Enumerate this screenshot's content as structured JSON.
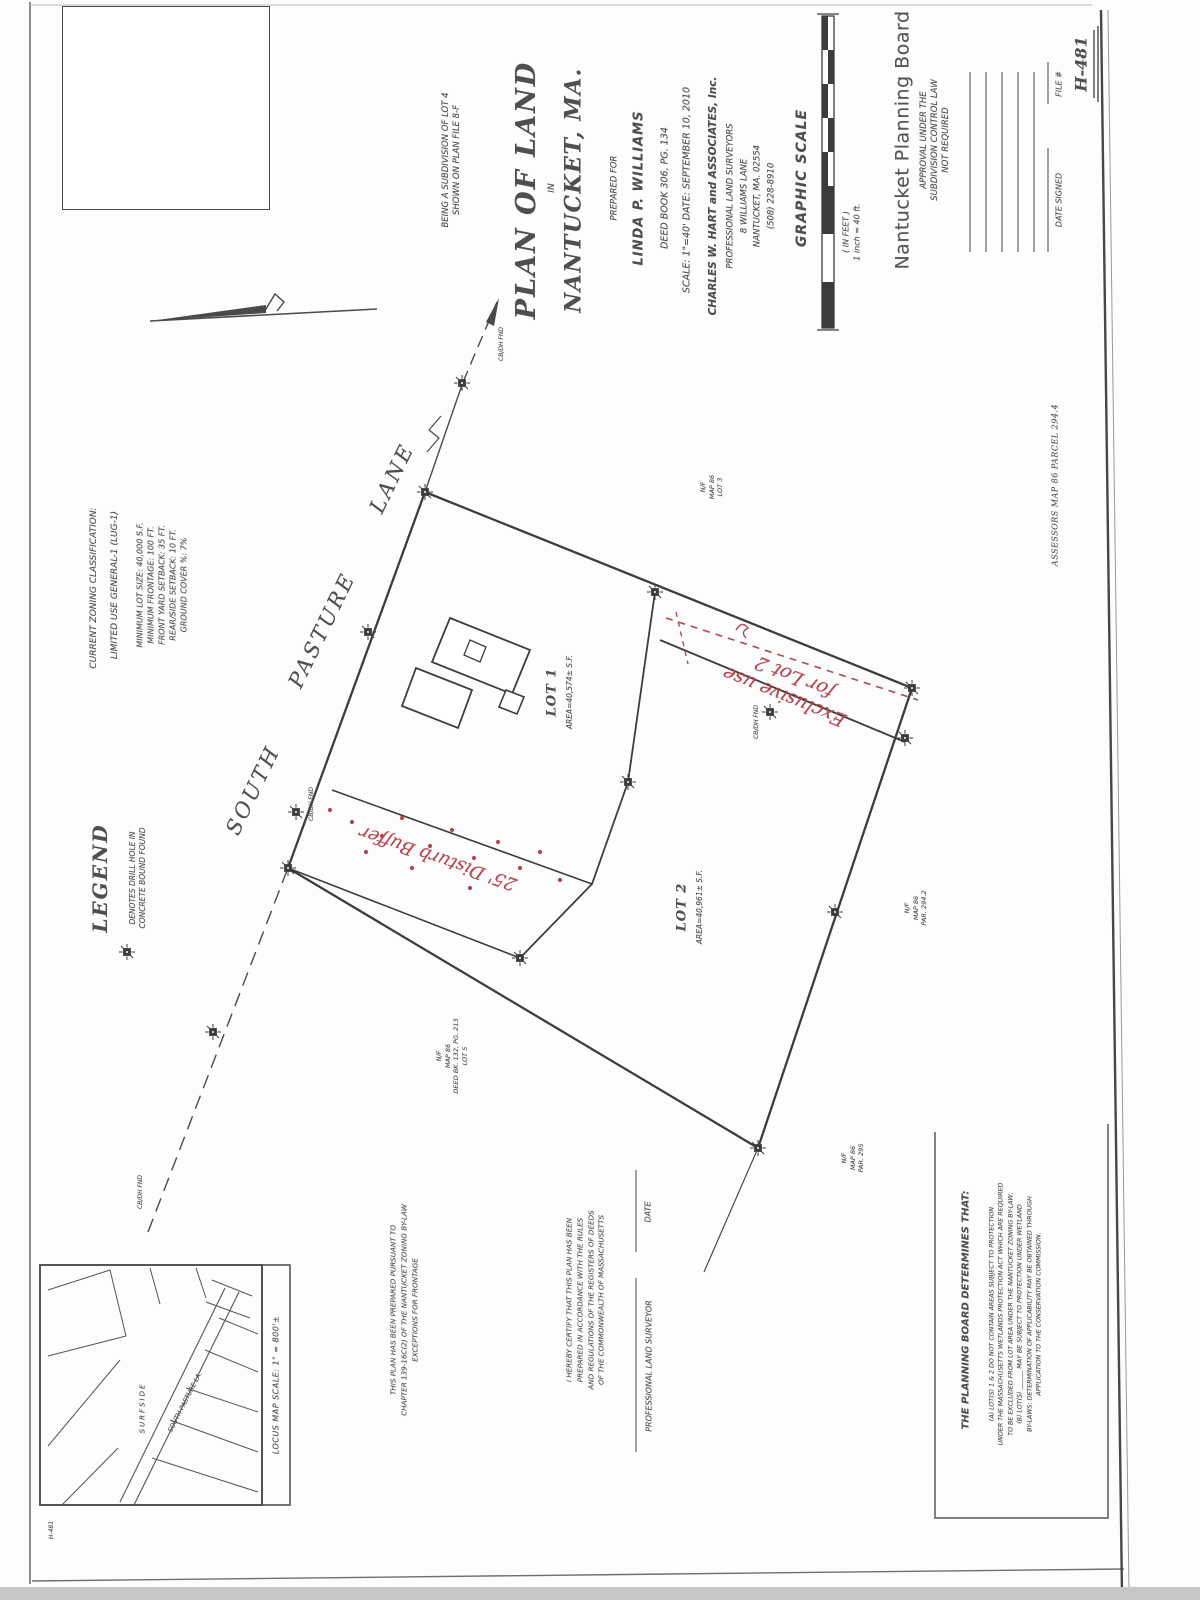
{
  "sheet": {
    "number": "H-481",
    "corner_note": "H-481",
    "assessors_note": "ASSESSORS MAP 86   PARCEL 294.4"
  },
  "title_block": {
    "subdivision_note_line1": "BEING A SUBDIVISION OF LOT 4",
    "subdivision_note_line2": "SHOWN ON PLAN FILE 8-F",
    "title_line1": "PLAN OF LAND",
    "title_in": "IN",
    "title_line2": "NANTUCKET, MA.",
    "prepared_for_label": "PREPARED FOR",
    "client": "LINDA P. WILLIAMS",
    "deed_ref": "DEED BOOK 306, PG. 134",
    "scale_date": "SCALE: 1\"=40'    DATE: SEPTEMBER 10, 2010",
    "firm": "CHARLES W. HART and ASSOCIATES, Inc.",
    "firm_line2": "PROFESSIONAL LAND SURVEYORS",
    "firm_addr1": "8 WILLIAMS LANE",
    "firm_addr2": "NANTUCKET, MA. 02554",
    "firm_phone": "(508) 228-8910"
  },
  "graphic_scale": {
    "label": "GRAPHIC SCALE",
    "in_feet": "( IN FEET )",
    "inch_note": "1 inch = 40 ft."
  },
  "planning_board": {
    "title": "Nantucket Planning Board",
    "approval_lines": [
      "APPROVAL UNDER THE",
      "SUBDIVISION CONTROL LAW",
      "NOT REQUIRED"
    ],
    "date_signed_label": "DATE SIGNED",
    "file_label": "FILE #"
  },
  "zoning": {
    "lines": [
      "CURRENT ZONING CLASSIFICATION:",
      "LIMITED USE GENERAL-1 (LUG-1)",
      "MINIMUM LOT SIZE: 40,000 S.F.",
      "MINIMUM FRONTAGE: 100 FT.",
      "FRONT YARD SETBACK: 35 FT.",
      "REAR/SIDE SETBACK: 10 FT.",
      "GROUND COVER %: 7%"
    ]
  },
  "legend": {
    "title": "LEGEND",
    "item_line1": "DENOTES DRILL HOLE IN",
    "item_line2": "CONCRETE BOUND FOUND"
  },
  "road": {
    "word1": "SOUTH",
    "word2": "PASTURE",
    "word3": "LANE"
  },
  "lots": {
    "lot1": {
      "name": "LOT 1",
      "area": "AREA=40,574± S.F."
    },
    "lot2": {
      "name": "LOT 2",
      "area": "AREA=40,961± S.F."
    }
  },
  "red_annotations": {
    "color": "#b5454e",
    "exclusive_line1": "Exclusive use",
    "exclusive_line2": "for Lot 2",
    "buffer": "25' Disturb Buffer"
  },
  "marks": {
    "found": "CB/DH FND"
  },
  "neighbors": [
    {
      "lines": [
        "N/F",
        "MAP 86",
        "LOT 3"
      ]
    },
    {
      "lines": [
        "N/F",
        "MAP 86",
        "PAR. 294.2"
      ]
    },
    {
      "lines": [
        "N/F",
        "MAP 86",
        "PAR. 295"
      ]
    },
    {
      "lines": [
        "N/F",
        "MAP 86",
        "DEED BK. 132, PG. 213",
        "LOT 5"
      ]
    }
  ],
  "certifications": {
    "pursuant": {
      "lines": [
        "THIS PLAN HAS BEEN PREPARED PURSUANT TO",
        "CHAPTER 139-16C(2) OF THE NANTUCKET ZONING BY-LAW",
        "EXCEPTIONS FOR FRONTAGE"
      ]
    },
    "registry": {
      "lines": [
        "I HEREBY CERTIFY THAT THIS PLAN HAS BEEN",
        "PREPARED IN ACCORDANCE WITH THE RULES",
        "AND REGULATIONS OF THE REGISTERS OF DEEDS",
        "OF THE COMMONWEALTH OF MASSACHUSETTS"
      ]
    },
    "surveyor_label": "PROFESSIONAL LAND SURVEYOR",
    "date_label": "DATE"
  },
  "board_notes": {
    "title": "THE PLANNING BOARD DETERMINES THAT:",
    "lines": [
      "(A) LOT(S)  1 & 2  DO NOT CONTAIN AREAS SUBJECT TO PROTECTION",
      "UNDER THE MASSACHUSETTS WETLANDS PROTECTION ACT WHICH ARE REQUIRED",
      "TO BE EXCLUDED FROM LOT AREA UNDER THE NANTUCKET ZONING BY-LAW;",
      "(B) LOT(S) ______ MAY BE SUBJECT TO PROTECTION UNDER WETLAND",
      "BY-LAWS; DETERMINATION OF APPLICABILITY MAY BE OBTAINED THROUGH",
      "APPLICATION TO THE CONSERVATION COMMISSION."
    ]
  },
  "locus_map": {
    "caption": "LOCUS MAP    SCALE: 1\" = 800'±",
    "area_label": "SURFSIDE",
    "road_label": "SOUTH PASTURE LA."
  }
}
